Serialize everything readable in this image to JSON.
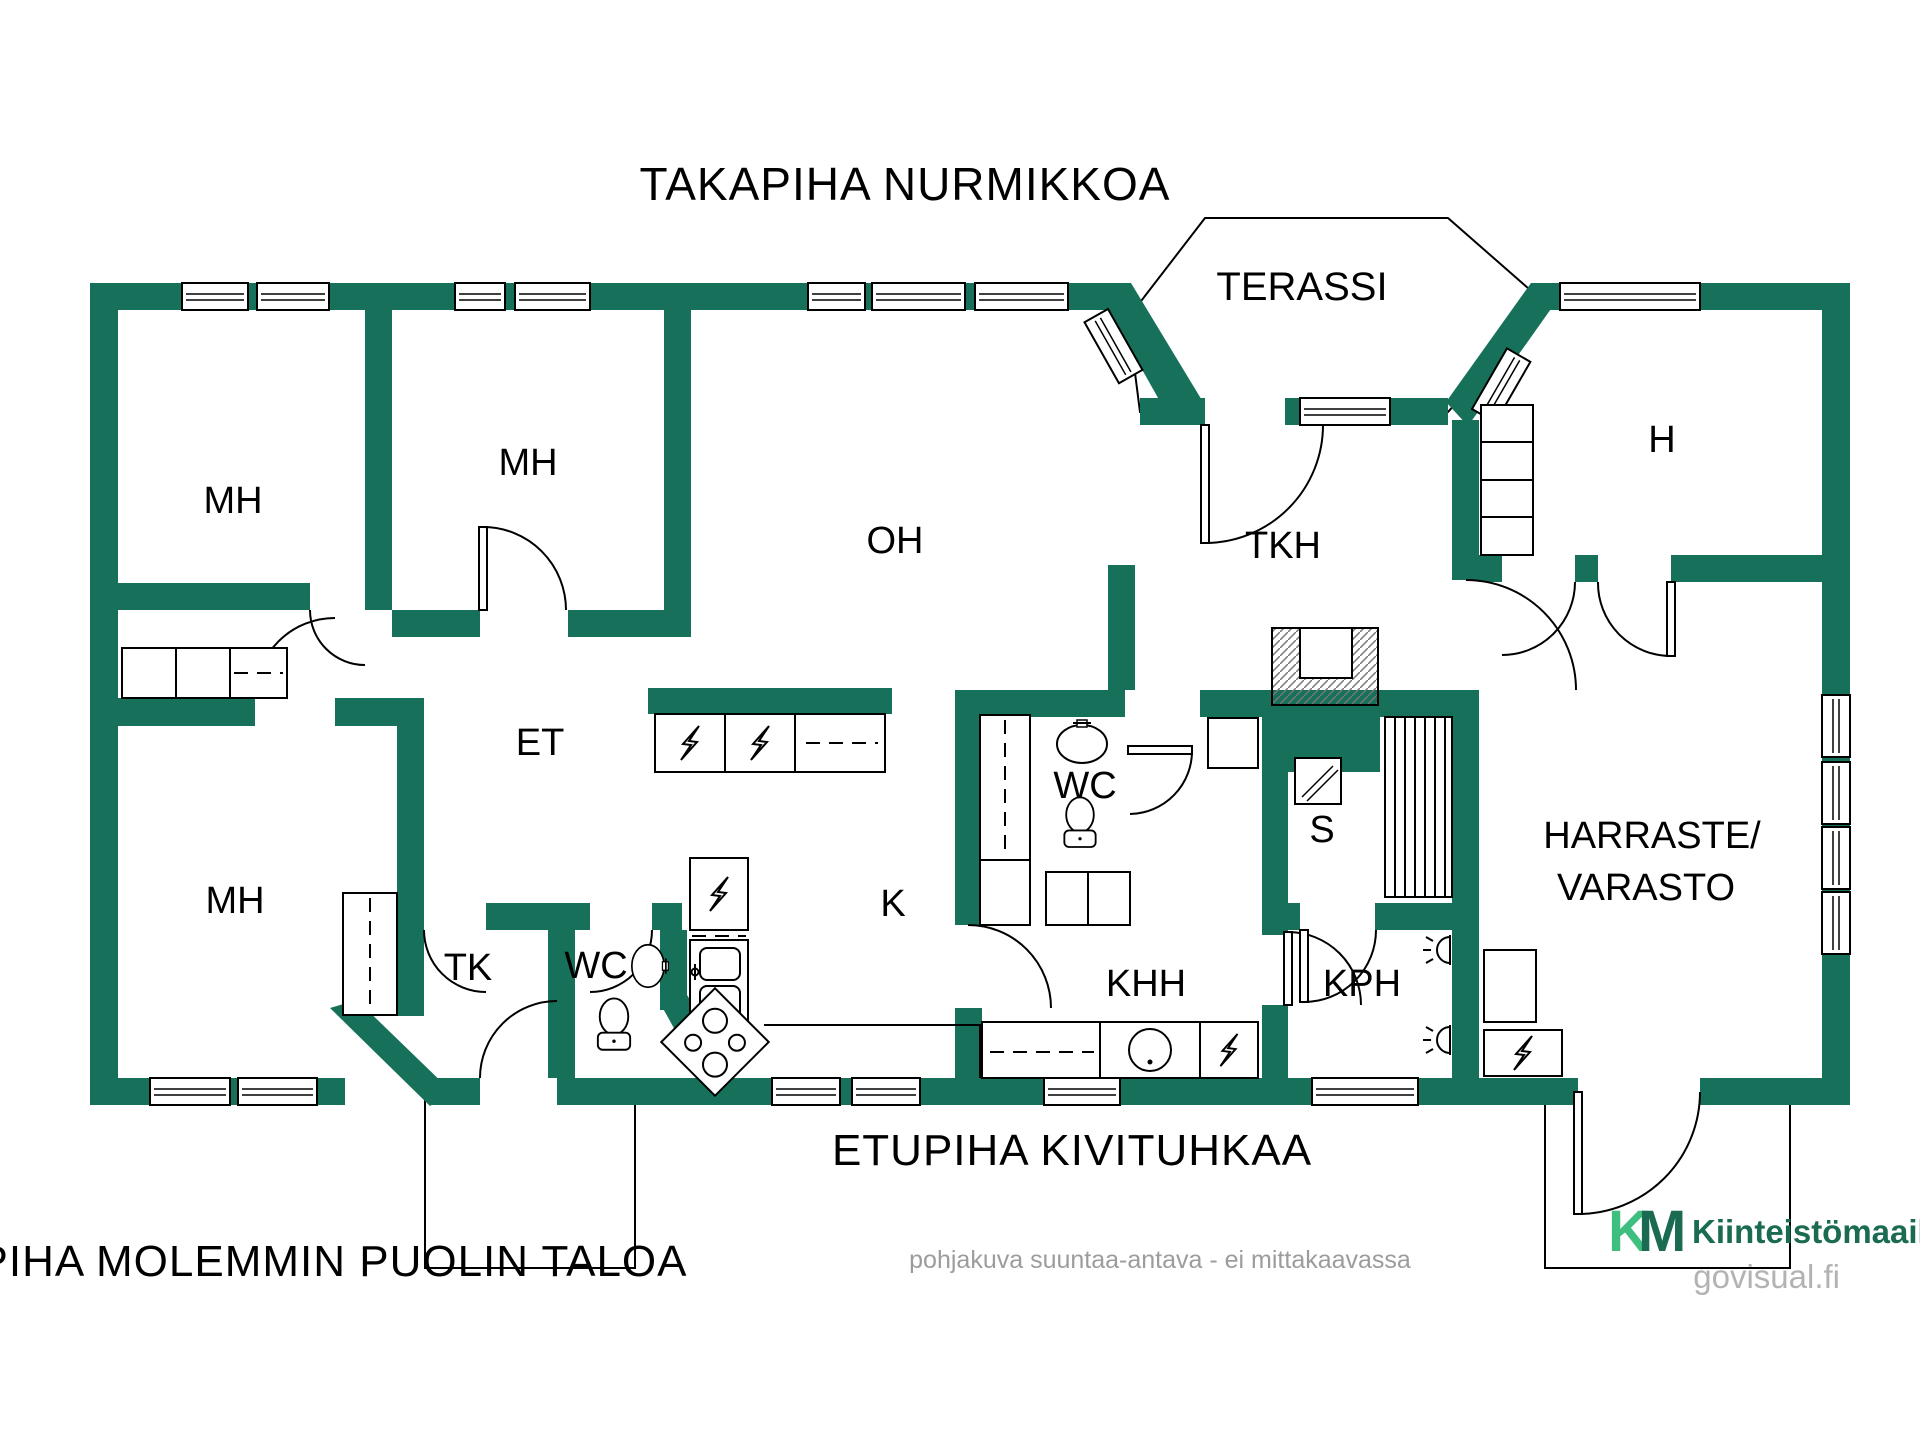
{
  "colors": {
    "wall": "#17715A",
    "line": "#000000",
    "muted": "#9C9C9C",
    "logo_green_light": "#3FBF7F",
    "logo_green_dark": "#1A6B52"
  },
  "captions": {
    "back_yard": "TAKAPIHA NURMIKKOA",
    "front_yard": "ETUPIHA KIVITUHKAA",
    "side_yard": "PIHA MOLEMMIN PUOLIN TALOA",
    "disclaimer": "pohjakuva suuntaa-antava - ei mittakaavassa"
  },
  "rooms": [
    {
      "id": "terassi",
      "label": "TERASSI"
    },
    {
      "id": "mh-top-left",
      "label": "MH"
    },
    {
      "id": "mh-top-mid",
      "label": "MH"
    },
    {
      "id": "mh-bottom-left",
      "label": "MH"
    },
    {
      "id": "oh",
      "label": "OH"
    },
    {
      "id": "tkh",
      "label": "TKH"
    },
    {
      "id": "h",
      "label": "H"
    },
    {
      "id": "et",
      "label": "ET"
    },
    {
      "id": "tk",
      "label": "TK"
    },
    {
      "id": "wc-entry",
      "label": "WC"
    },
    {
      "id": "k",
      "label": "K"
    },
    {
      "id": "wc-middle",
      "label": "WC"
    },
    {
      "id": "khh",
      "label": "KHH"
    },
    {
      "id": "kph",
      "label": "KPH"
    },
    {
      "id": "s",
      "label": "S"
    },
    {
      "id": "harraste-varasto",
      "lines": [
        "HARRASTE/",
        "VARASTO"
      ]
    }
  ],
  "branding": {
    "logo_k": "K",
    "logo_m": "M",
    "company": "Kiinteistömaailma",
    "site": "govisual.fi"
  }
}
